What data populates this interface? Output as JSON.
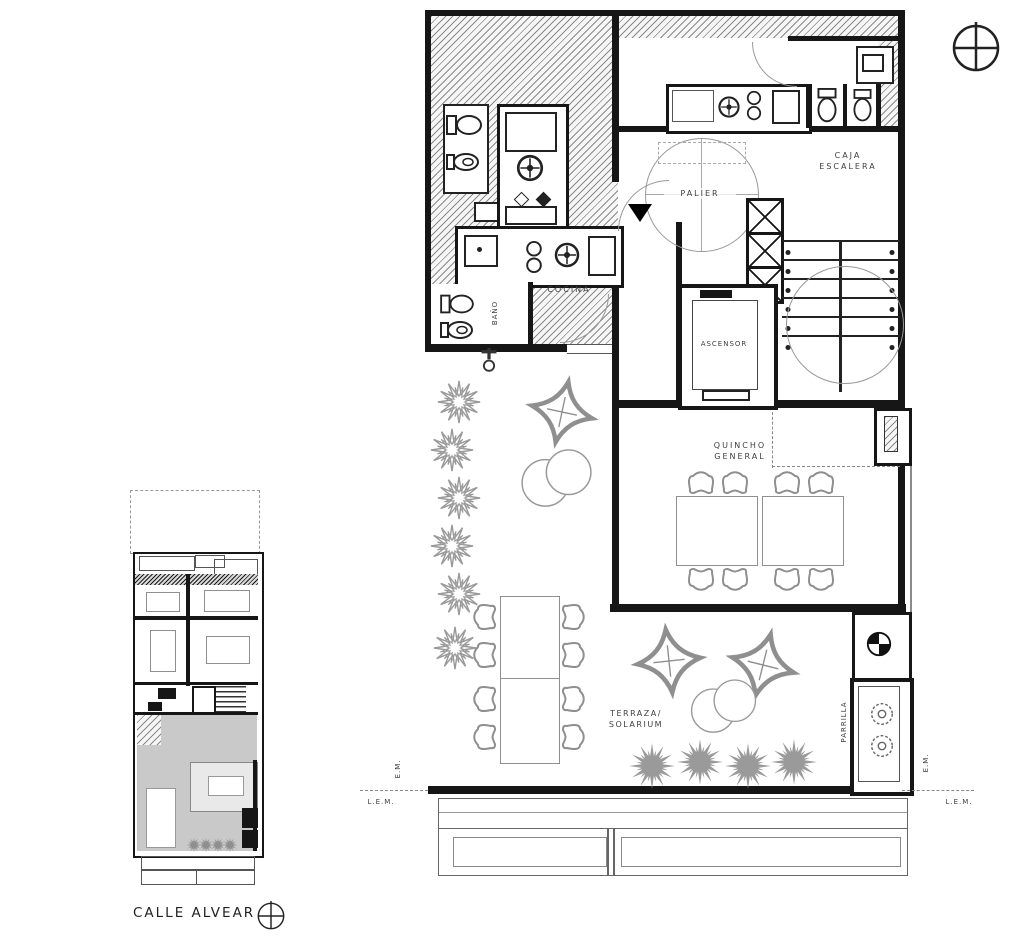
{
  "colors": {
    "ink": "#161616",
    "furniture_stroke": "#8f8f8f",
    "hatch": "#8a8a8a",
    "terrace_key_fill": "#c9c9c9"
  },
  "icons": {
    "compass_top": "compass-crosshair-icon",
    "compass_bottom": "compass-crosshair-icon",
    "direction_arrow": "black-triangle-marker",
    "faucet": "faucet-icon",
    "drain": "floor-drain-icon"
  },
  "main_plan": {
    "rooms": {
      "palier": "PALIER",
      "caja_escalera": [
        "CAJA",
        "ESCALERA"
      ],
      "ascensor": "ASCENSOR",
      "cocina": "COCINA",
      "bano": "BAÑO",
      "quincho": [
        "QUINCHO",
        "GENERAL"
      ],
      "terraza": [
        "TERRAZA/",
        "SOLARIUM"
      ],
      "parrilla": "PARRILLA"
    },
    "annotations": {
      "em": "E.M.",
      "lem": "L.E.M."
    }
  },
  "key_plan": {
    "street": "CALLE ALVEAR"
  }
}
